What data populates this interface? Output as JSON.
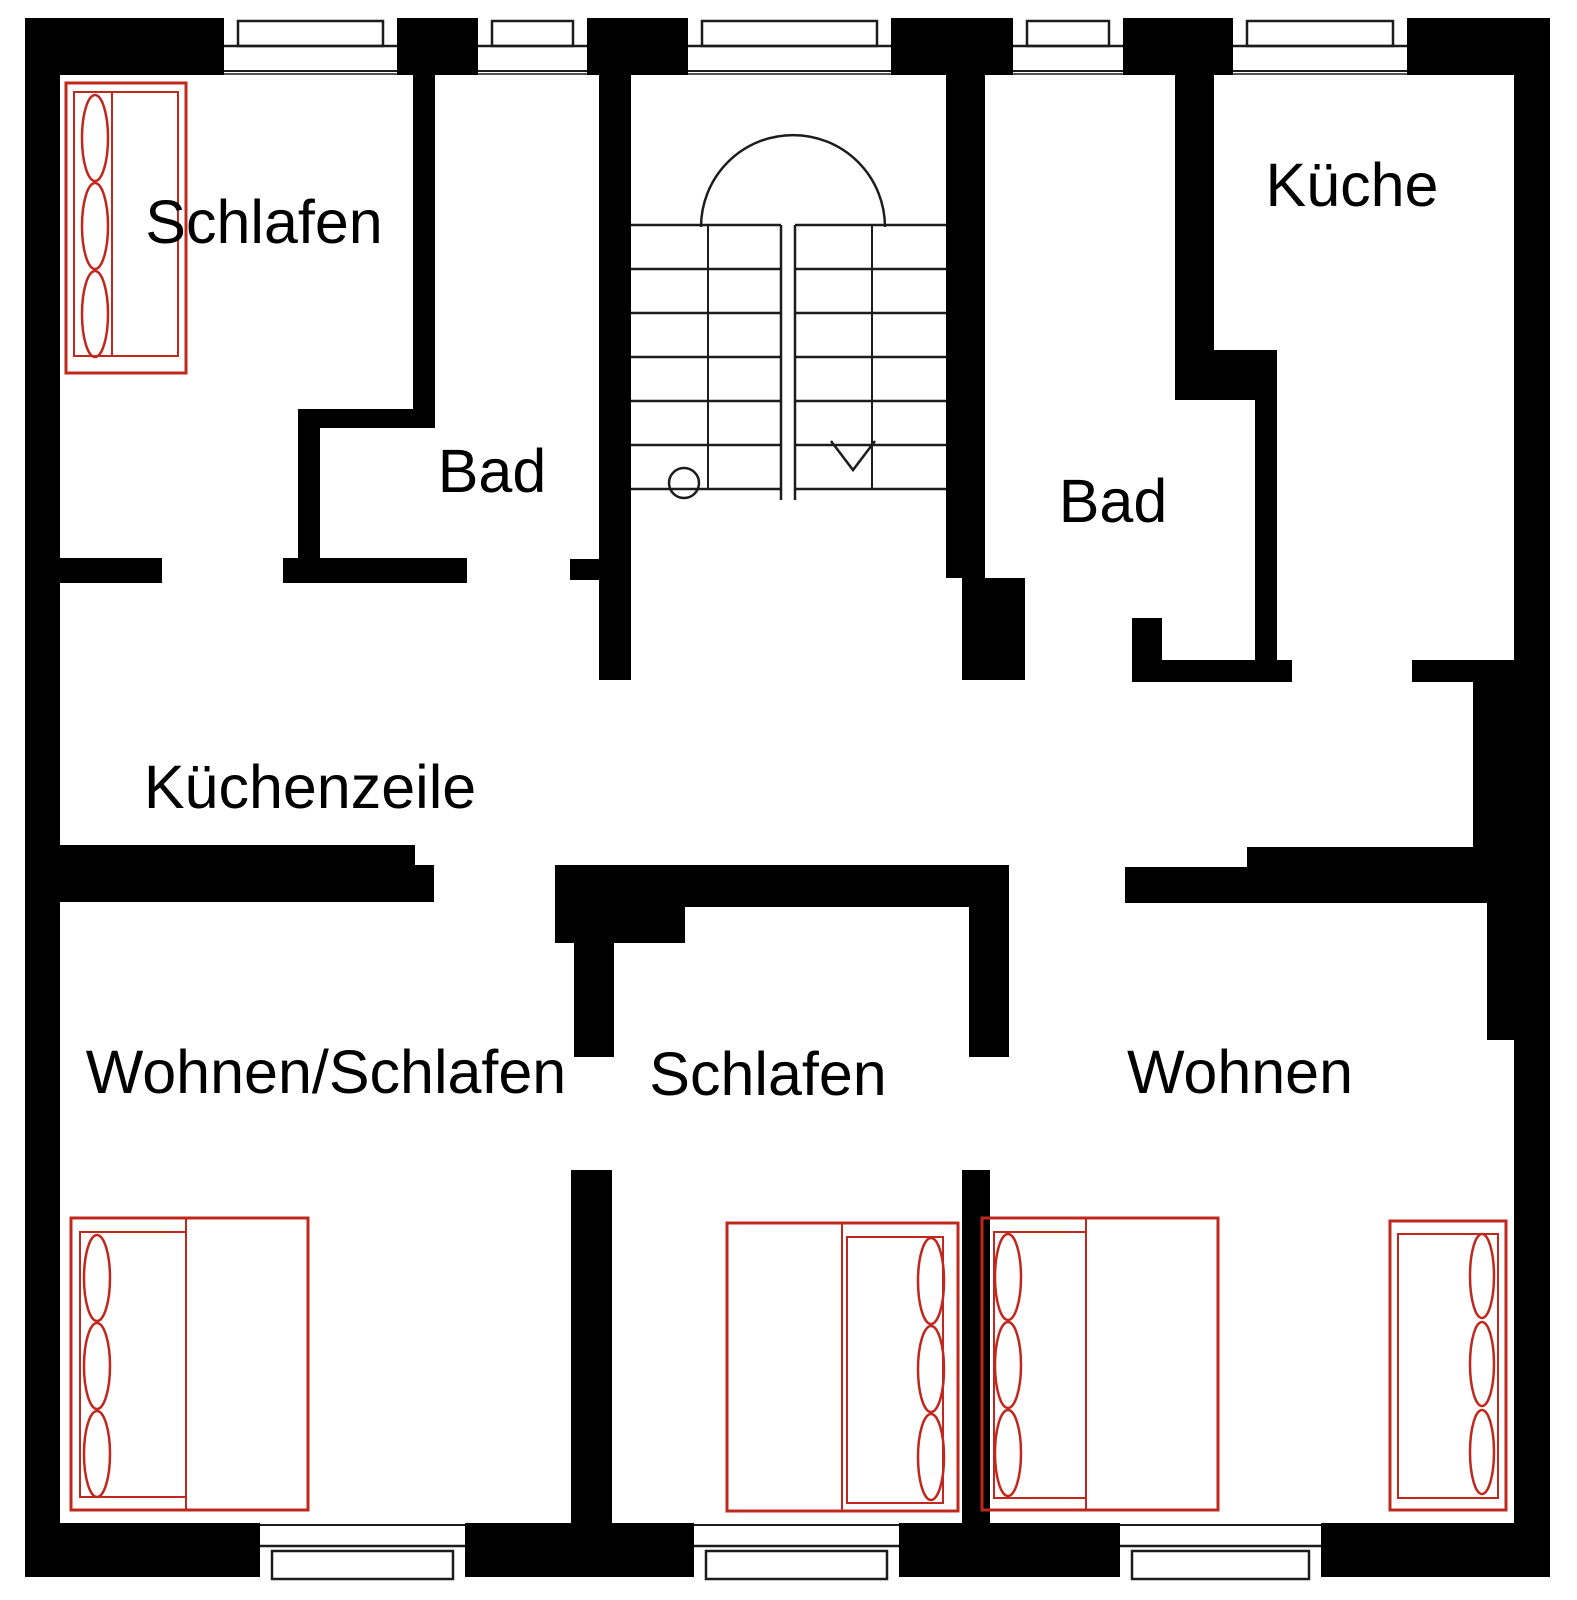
{
  "colors": {
    "wall": "#000000",
    "background": "#ffffff",
    "furniture_red": "#c0281e",
    "thin_line": "#1c1c1c"
  },
  "rooms": [
    {
      "id": "schlafen-top-left",
      "label": "Schlafen",
      "x": 264,
      "y": 243
    },
    {
      "id": "bad-left",
      "label": "Bad",
      "x": 492,
      "y": 492
    },
    {
      "id": "kueche",
      "label": "Küche",
      "x": 1352,
      "y": 206
    },
    {
      "id": "bad-right",
      "label": "Bad",
      "x": 1113,
      "y": 522
    },
    {
      "id": "kuechenzeile",
      "label": "Küchenzeile",
      "x": 310,
      "y": 808
    },
    {
      "id": "wohnen-schlafen",
      "label": "Wohnen/Schlafen",
      "x": 326,
      "y": 1093
    },
    {
      "id": "schlafen-bottom",
      "label": "Schlafen",
      "x": 768,
      "y": 1095
    },
    {
      "id": "wohnen",
      "label": "Wohnen",
      "x": 1240,
      "y": 1093
    }
  ],
  "plan": {
    "width": 1577,
    "height": 1600,
    "walls": [
      {
        "n": "outer-top-seg-1",
        "r": [
          25,
          18,
          199,
          57
        ]
      },
      {
        "n": "outer-top-seg-2",
        "r": [
          397,
          18,
          81,
          57
        ]
      },
      {
        "n": "outer-top-seg-3",
        "r": [
          587,
          18,
          101,
          57
        ]
      },
      {
        "n": "outer-top-seg-4",
        "r": [
          891,
          18,
          122,
          57
        ]
      },
      {
        "n": "outer-top-seg-5",
        "r": [
          1123,
          18,
          110,
          57
        ]
      },
      {
        "n": "outer-top-seg-6",
        "r": [
          1407,
          18,
          143,
          57
        ]
      },
      {
        "n": "outer-left",
        "r": [
          25,
          18,
          35,
          1559
        ]
      },
      {
        "n": "outer-right",
        "r": [
          1514,
          18,
          36,
          1559
        ]
      },
      {
        "n": "outer-bottom-seg-1",
        "r": [
          25,
          1523,
          235,
          54
        ]
      },
      {
        "n": "outer-bottom-seg-2",
        "r": [
          465,
          1523,
          229,
          54
        ]
      },
      {
        "n": "outer-bottom-seg-3",
        "r": [
          899,
          1523,
          221,
          54
        ]
      },
      {
        "n": "outer-bottom-seg-4",
        "r": [
          1321,
          1523,
          229,
          54
        ]
      },
      {
        "n": "wall-schlafen-bad",
        "r": [
          413,
          75,
          22,
          353
        ]
      },
      {
        "n": "wall-bad-left-top",
        "r": [
          298,
          409,
          137,
          19
        ]
      },
      {
        "n": "wall-bad-left-side",
        "r": [
          298,
          409,
          22,
          171
        ]
      },
      {
        "n": "wall-schlafen-bottom",
        "r": [
          60,
          558,
          102,
          25
        ]
      },
      {
        "n": "wall-bad-left-bottom",
        "r": [
          283,
          558,
          184,
          25
        ]
      },
      {
        "n": "wall-stub-stair",
        "r": [
          570,
          559,
          61,
          21
        ]
      },
      {
        "n": "wall-stair-left",
        "r": [
          599,
          75,
          32,
          605
        ]
      },
      {
        "n": "wall-stair-right-upper",
        "r": [
          946,
          75,
          39,
          503
        ]
      },
      {
        "n": "wall-stair-right-lower",
        "r": [
          962,
          578,
          63,
          102
        ]
      },
      {
        "n": "wall-bad-kueche-upper",
        "r": [
          1175,
          75,
          39,
          325
        ]
      },
      {
        "n": "wall-bad-kueche-step",
        "r": [
          1214,
          350,
          63,
          50
        ]
      },
      {
        "n": "wall-bad-kueche-lower",
        "r": [
          1255,
          400,
          22,
          260
        ]
      },
      {
        "n": "wall-bad-right-stub",
        "r": [
          1132,
          618,
          30,
          42
        ]
      },
      {
        "n": "wall-bad-right-bottom",
        "r": [
          1132,
          660,
          160,
          22
        ]
      },
      {
        "n": "wall-kueche-bottom",
        "r": [
          1412,
          660,
          116,
          22
        ]
      },
      {
        "n": "wall-right-protrusion",
        "r": [
          1473,
          660,
          41,
          187
        ]
      },
      {
        "n": "wall-corridor-left-a",
        "r": [
          60,
          845,
          355,
          20
        ]
      },
      {
        "n": "wall-corridor-left-b",
        "r": [
          60,
          865,
          374,
          37
        ]
      },
      {
        "n": "wall-corridor-mid",
        "r": [
          555,
          865,
          454,
          42
        ]
      },
      {
        "n": "wall-schlafen2-block",
        "r": [
          555,
          907,
          130,
          36
        ]
      },
      {
        "n": "wall-schlafen2-left-up",
        "r": [
          574,
          943,
          40,
          114
        ]
      },
      {
        "n": "wall-schlafen2-left-dn",
        "r": [
          571,
          1170,
          41,
          353
        ]
      },
      {
        "n": "wall-schlafen2-right-up",
        "r": [
          969,
          907,
          40,
          150
        ]
      },
      {
        "n": "wall-schlafen2-right-dn",
        "r": [
          962,
          1170,
          28,
          353
        ]
      },
      {
        "n": "wall-corridor-right-a",
        "r": [
          1247,
          847,
          240,
          20
        ]
      },
      {
        "n": "wall-corridor-right-b",
        "r": [
          1125,
          867,
          362,
          36
        ]
      },
      {
        "n": "wall-right-column",
        "r": [
          1487,
          847,
          33,
          193
        ]
      }
    ],
    "windows": {
      "top": [
        {
          "x": 224,
          "w": 173
        },
        {
          "x": 478,
          "w": 109
        },
        {
          "x": 688,
          "w": 203
        },
        {
          "x": 1013,
          "w": 110
        },
        {
          "x": 1233,
          "w": 174
        }
      ],
      "bottom": [
        {
          "x": 260,
          "w": 205
        },
        {
          "x": 694,
          "w": 205
        },
        {
          "x": 1120,
          "w": 201
        }
      ],
      "top_band": {
        "y": 18,
        "h": 57,
        "box_y": 21,
        "box_h": 25,
        "inset": 14,
        "line1": 46,
        "line2": 71,
        "line3": 74
      },
      "bottom_band": {
        "y": 1523,
        "h": 54,
        "box_y": 1551,
        "box_h": 28,
        "inset": 12,
        "line1": 1525,
        "line2": 1546
      }
    },
    "staircase": {
      "left_flight": {
        "x1": 631,
        "x2": 781,
        "mid": 708
      },
      "right_flight": {
        "x1": 795,
        "x2": 946,
        "mid": 872
      },
      "treads_y": [
        225,
        269,
        313,
        357,
        401,
        445,
        489
      ],
      "divider_x": [
        781,
        795
      ],
      "divider_y1": 225,
      "divider_y2": 500,
      "arc": {
        "x1": 701,
        "x2": 885,
        "y": 227,
        "r": 92
      },
      "circle": {
        "cx": 684,
        "cy": 483,
        "r": 15
      },
      "arrow": [
        [
          831,
          441
        ],
        [
          853,
          470
        ],
        [
          875,
          441
        ]
      ]
    },
    "beds": [
      {
        "n": "bed-schlafen-top-left",
        "outer": [
          66,
          83,
          120,
          290
        ],
        "inner": [
          74,
          92,
          104,
          264
        ],
        "divider": {
          "x": 112,
          "y1": 92,
          "y2": 356
        },
        "pillows": {
          "cx": 95,
          "cy": [
            138,
            226,
            314
          ],
          "rx": 13,
          "ry": 43
        }
      },
      {
        "n": "bed-wohnen-schlafen",
        "outer": [
          71,
          1218,
          237,
          292
        ],
        "inner": [
          80,
          1232,
          106,
          265
        ],
        "divider": {
          "x": 186,
          "y1": 1218,
          "y2": 1510
        },
        "pillows": {
          "cx": 97,
          "cy": [
            1278,
            1366,
            1454
          ],
          "rx": 13,
          "ry": 43
        }
      },
      {
        "n": "bed-schlafen-bottom",
        "outer": [
          727,
          1223,
          231,
          288
        ],
        "inner": [
          847,
          1237,
          96,
          266
        ],
        "divider": {
          "x": 842,
          "y1": 1223,
          "y2": 1511
        },
        "pillows": {
          "cx": 931,
          "cy": [
            1281,
            1369,
            1457
          ],
          "rx": 13,
          "ry": 43
        }
      },
      {
        "n": "bed-wohnen-double",
        "outer": [
          982,
          1218,
          236,
          292
        ],
        "inner": [
          994,
          1232,
          92,
          266
        ],
        "divider": {
          "x": 1086,
          "y1": 1218,
          "y2": 1510
        },
        "pillows": {
          "cx": 1008,
          "cy": [
            1277,
            1365,
            1453
          ],
          "rx": 13,
          "ry": 43
        }
      },
      {
        "n": "bed-wohnen-single",
        "outer": [
          1390,
          1221,
          116,
          289
        ],
        "inner": [
          1398,
          1234,
          100,
          264
        ],
        "divider": null,
        "pillows": {
          "cx": 1482,
          "cy": [
            1276,
            1364,
            1452
          ],
          "rx": 12,
          "ry": 42
        }
      }
    ]
  }
}
